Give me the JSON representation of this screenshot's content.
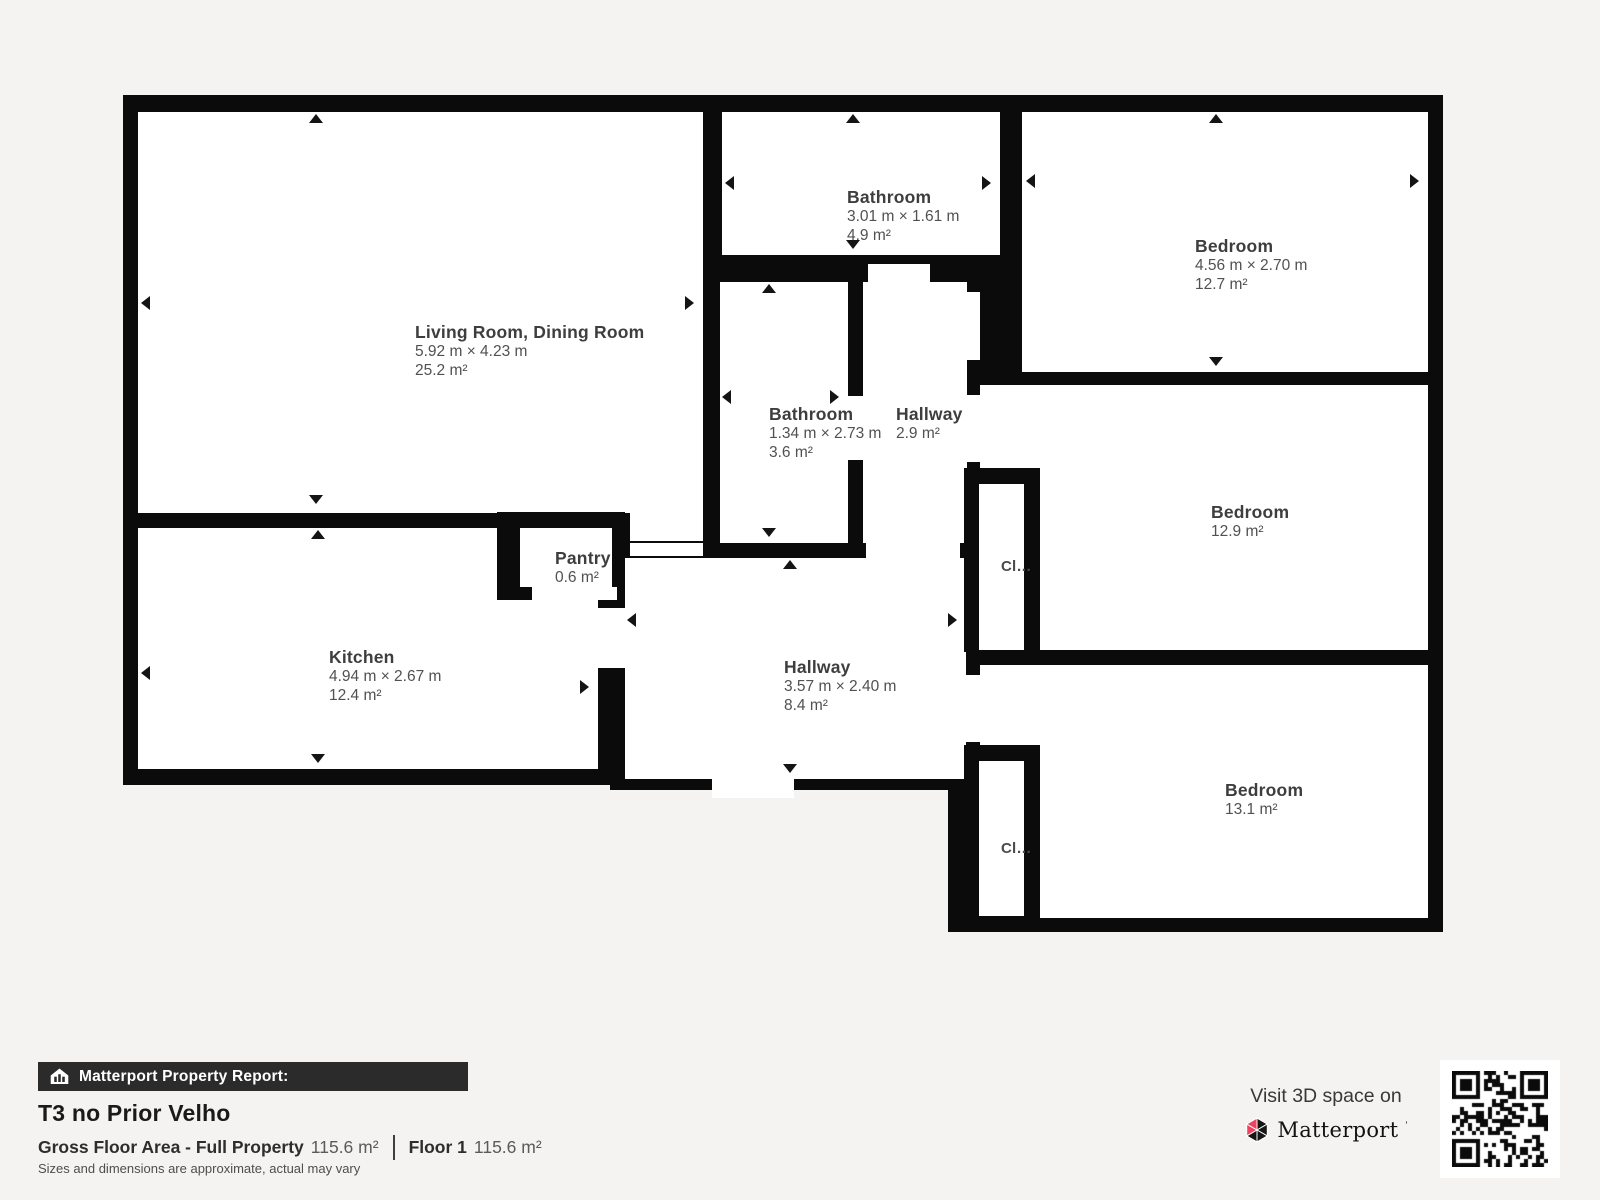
{
  "page": {
    "background": "#f4f3f1",
    "wall_color": "#0b0b0b",
    "room_color": "#ffffff"
  },
  "plan": {
    "walls": [
      [
        123,
        95,
        585,
        690
      ],
      [
        693,
        95,
        312,
        463
      ],
      [
        610,
        528,
        352,
        262
      ],
      [
        948,
        95,
        495,
        837
      ]
    ],
    "rooms": [
      {
        "id": "living-dining-room",
        "name": "Living Room, Dining Room",
        "dims": "5.92 m × 4.23 m",
        "area": "25.2 m²",
        "rects": [
          [
            138,
            112,
            565,
            401
          ],
          [
            630,
            513,
            73,
            28
          ]
        ],
        "label": [
          415,
          322
        ],
        "arrows": [
          [
            "up",
            309,
            114
          ],
          [
            "down",
            309,
            495
          ],
          [
            "left",
            141,
            296
          ],
          [
            "right",
            685,
            296
          ]
        ]
      },
      {
        "id": "bathroom-1",
        "name": "Bathroom",
        "dims": "3.01 m × 1.61 m",
        "area": "4.9 m²",
        "rects": [
          [
            722,
            112,
            278,
            143
          ]
        ],
        "label": [
          847,
          187
        ],
        "arrows": [
          [
            "up",
            846,
            114
          ],
          [
            "down",
            846,
            240
          ],
          [
            "left",
            725,
            176
          ],
          [
            "right",
            982,
            176
          ]
        ]
      },
      {
        "id": "bedroom-1",
        "name": "Bedroom",
        "dims": "4.56 m × 2.70 m",
        "area": "12.7 m²",
        "rects": [
          [
            1022,
            112,
            406,
            260
          ]
        ],
        "label": [
          1195,
          236
        ],
        "arrows": [
          [
            "up",
            1209,
            114
          ],
          [
            "down",
            1209,
            357
          ],
          [
            "left",
            1026,
            174
          ],
          [
            "right",
            1410,
            174
          ]
        ]
      },
      {
        "id": "bathroom-2",
        "name": "Bathroom",
        "dims": "1.34 m × 2.73 m",
        "area": "3.6 m²",
        "rects": [
          [
            720,
            282,
            128,
            261
          ]
        ],
        "label": [
          769,
          404
        ],
        "arrows": [
          [
            "up",
            762,
            284
          ],
          [
            "down",
            762,
            528
          ],
          [
            "left",
            722,
            390
          ],
          [
            "right",
            830,
            390
          ]
        ]
      },
      {
        "id": "hallway-small",
        "name": "Hallway",
        "dims": null,
        "area": "2.9 m²",
        "rects": [
          [
            863,
            282,
            104,
            261
          ]
        ],
        "label": [
          896,
          404
        ],
        "arrows": []
      },
      {
        "id": "kitchen",
        "name": "Kitchen",
        "dims": "4.94 m × 2.67 m",
        "area": "12.4 m²",
        "rects": [
          [
            138,
            528,
            460,
            241
          ]
        ],
        "label": [
          329,
          647
        ],
        "arrows": [
          [
            "up",
            311,
            530
          ],
          [
            "down",
            311,
            754
          ],
          [
            "left",
            141,
            666
          ],
          [
            "right",
            580,
            680
          ]
        ]
      },
      {
        "id": "hallway-main",
        "name": "Hallway",
        "dims": "3.57 m × 2.40 m",
        "area": "8.4 m²",
        "rects": [
          [
            625,
            558,
            341,
            221
          ]
        ],
        "label": [
          784,
          657
        ],
        "arrows": [
          [
            "up",
            783,
            560
          ],
          [
            "down",
            783,
            764
          ],
          [
            "left",
            627,
            613
          ],
          [
            "right",
            948,
            613
          ]
        ]
      },
      {
        "id": "bedroom-2",
        "name": "Bedroom",
        "dims": null,
        "area": "12.9 m²",
        "rects": [
          [
            980,
            385,
            448,
            265
          ]
        ],
        "label": [
          1211,
          502
        ],
        "arrows": []
      },
      {
        "id": "bedroom-3",
        "name": "Bedroom",
        "dims": null,
        "area": "13.1 m²",
        "rects": [
          [
            980,
            665,
            448,
            253
          ]
        ],
        "label": [
          1225,
          780
        ],
        "arrows": []
      }
    ],
    "subrooms": [
      {
        "id": "pantry",
        "name": "Pantry",
        "area": "0.6 m²",
        "small": false,
        "block": [
          497,
          512,
          128,
          88
        ],
        "interior": [
          520,
          528,
          92,
          59
        ],
        "label": [
          555,
          548
        ]
      },
      {
        "id": "closet-1",
        "name": "Cl…",
        "area": null,
        "small": true,
        "block": [
          964,
          468,
          76,
          184
        ],
        "interior": [
          979,
          484,
          45,
          166
        ],
        "label": [
          1001,
          557
        ]
      },
      {
        "id": "closet-2",
        "name": "Cl…",
        "area": null,
        "small": true,
        "block": [
          964,
          745,
          76,
          187
        ],
        "interior": [
          979,
          761,
          45,
          155
        ],
        "label": [
          1001,
          839
        ]
      }
    ],
    "doors": [
      [
        630,
        543,
        73,
        13
      ],
      [
        866,
        543,
        94,
        15
      ],
      [
        598,
        608,
        27,
        60
      ],
      [
        848,
        396,
        15,
        64
      ],
      [
        868,
        264,
        62,
        18
      ],
      [
        967,
        292,
        13,
        68
      ],
      [
        967,
        395,
        13,
        67
      ],
      [
        966,
        675,
        14,
        67
      ],
      [
        712,
        770,
        82,
        28
      ],
      [
        532,
        587,
        85,
        13
      ]
    ]
  },
  "footer": {
    "bar_color": "#2b2b2b",
    "bar_label": "Matterport Property Report:",
    "title": "T3 no Prior Velho",
    "gfa_label": "Gross Floor Area - Full Property",
    "gfa_value": "115.6 m²",
    "floor_label": "Floor 1",
    "floor_value": "115.6 m²",
    "disclaimer": "Sizes and dimensions are approximate, actual may vary"
  },
  "cta": {
    "visit_text": "Visit 3D space on",
    "brand": "Matterport",
    "brand_mark": "ʼ",
    "brand_pink": "#f04361"
  }
}
